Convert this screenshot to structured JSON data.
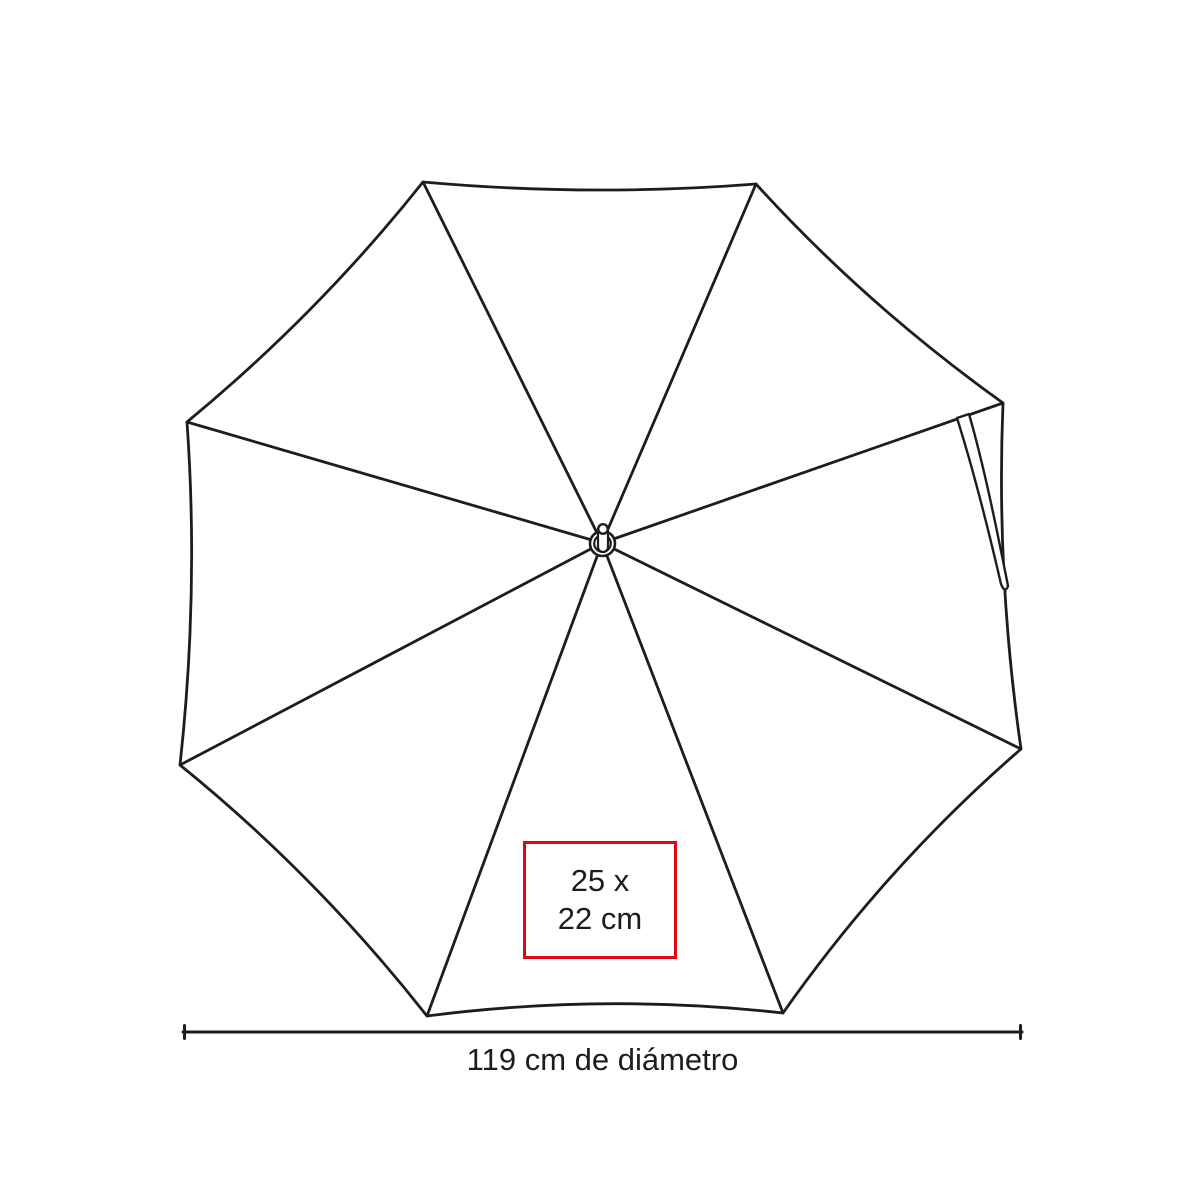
{
  "illustration": {
    "description": "Line drawing of an umbrella seen from the top with 8 panels, center ferrule hub and a hanging tie strap near the upper-right edge"
  },
  "print_area": {
    "line1": "25 x",
    "line2": "22 cm"
  },
  "dimension": {
    "label": "119 cm de diámetro"
  },
  "colors": {
    "line": "#1d1d1b",
    "accent_red": "#e30613",
    "text": "#1d1d1b",
    "background": "#ffffff"
  }
}
